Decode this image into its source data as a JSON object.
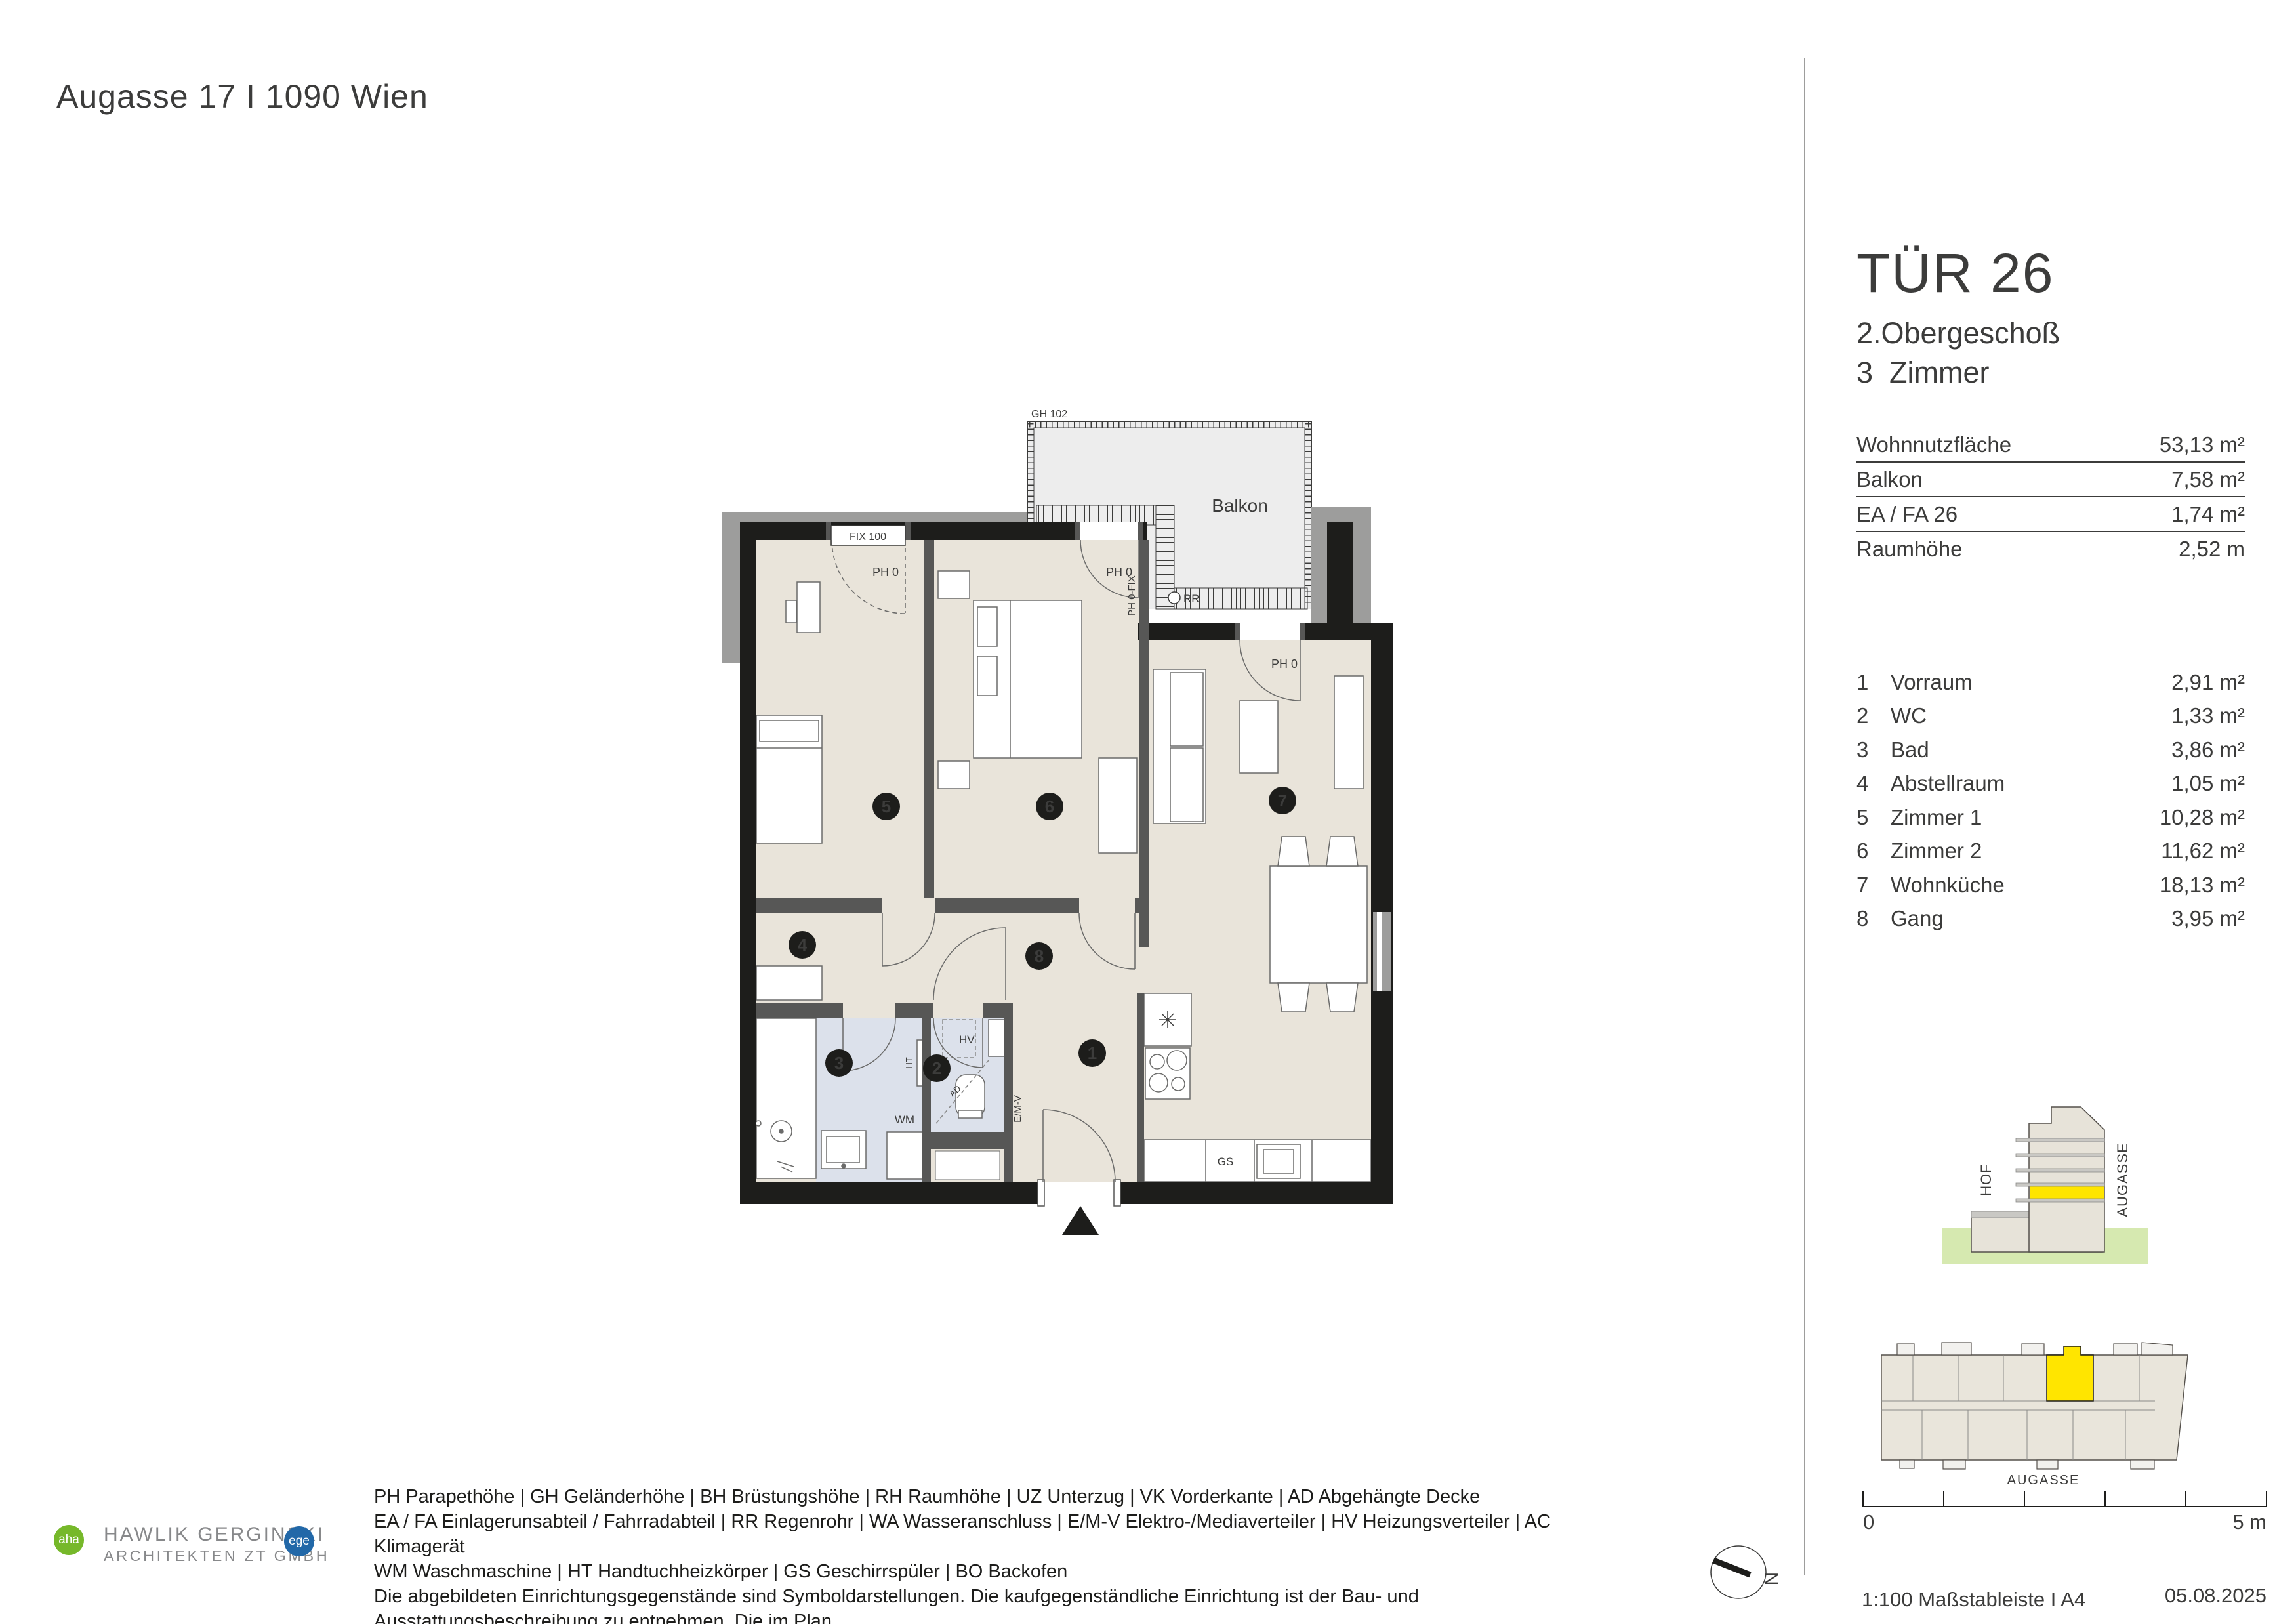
{
  "header": {
    "title": "Augasse 17 I 1090 Wien"
  },
  "unit_panel": {
    "title": "TÜR 26",
    "floor": "2.Obergeschoß",
    "rooms_count": "3  Zimmer",
    "summary": [
      {
        "label": "Wohnnutzfläche",
        "value": "53,13 m²"
      },
      {
        "label": "Balkon",
        "value": "7,58 m²"
      },
      {
        "label": "EA / FA 26",
        "value": "1,74 m²"
      },
      {
        "label": "Raumhöhe",
        "value": "2,52 m"
      }
    ],
    "room_list": [
      {
        "nr": "1",
        "name": "Vorraum",
        "area": "2,91 m²"
      },
      {
        "nr": "2",
        "name": "WC",
        "area": "1,33 m²"
      },
      {
        "nr": "3",
        "name": "Bad",
        "area": "3,86 m²"
      },
      {
        "nr": "4",
        "name": "Abstellraum",
        "area": "1,05 m²"
      },
      {
        "nr": "5",
        "name": "Zimmer 1",
        "area": "10,28 m²"
      },
      {
        "nr": "6",
        "name": "Zimmer 2",
        "area": "11,62 m²"
      },
      {
        "nr": "7",
        "name": "Wohnküche",
        "area": "18,13 m²"
      },
      {
        "nr": "8",
        "name": "Gang",
        "area": "3,95 m²"
      }
    ]
  },
  "plan": {
    "balcony": "Balkon",
    "gh": "GH 102",
    "fix": "FIX 100",
    "ph0": "PH 0",
    "ph0fix": "PH 0-FIX",
    "rr": "RR",
    "hv": "HV",
    "ad": "AD",
    "ht": "HT",
    "wm": "WM",
    "gs": "GS",
    "emv": "E/M-V",
    "badges": [
      "1",
      "2",
      "3",
      "4",
      "5",
      "6",
      "7",
      "8"
    ]
  },
  "elevation": {
    "hof": "HOF",
    "street": "AUGASSE"
  },
  "site_plan": {
    "street": "AUGASSE"
  },
  "scale_bar": {
    "zero": "0",
    "five": "5 m",
    "caption": "1:100 Maßstableiste I A4",
    "date": "05.08.2025",
    "north": "N"
  },
  "legend": {
    "lines": [
      "PH Parapethöhe | GH Geländerhöhe | BH Brüstungshöhe  |  RH Raumhöhe | UZ Unterzug | VK Vorderkante | AD Abgehängte Decke",
      "EA / FA Einlagerunsabteil / Fahrradabteil | RR Regenrohr | WA Wasseranschluss | E/M-V Elektro-/Mediaverteiler | HV Heizungsverteiler | AC Klimagerät",
      "WM Waschmaschine | HT Handtuchheizkörper | GS Geschirrspüler | BO Backofen",
      "Die abgebildeten Einrichtungsgegenstände sind Symboldarstellungen. Die kaufgegenständliche Einrichtung ist der Bau- und Ausstattungsbeschreibung zu entnehmen. Die im Plan",
      "dargestellten Abmessungen und Raumhöhen können im Zuge der Bauführung Änderungen unterliegen. Für die Bestellung von Einbaumöbeln sind Naturmaße heranzuziehen."
    ]
  },
  "logos": {
    "aha": "aha",
    "company_line1": "HAWLIK GERGINSKI",
    "company_line2": "ARCHITEKTEN ZT GMBH",
    "ege": "ege"
  },
  "colors": {
    "highlight_yellow": "#ffe500",
    "logo_green": "#76b82a",
    "logo_blue": "#2268a8",
    "ground_green": "#d6e9b0",
    "room_beige": "#e9e4da",
    "bath_blue": "#dce1eb",
    "balcony_gray": "#ededed",
    "wall_black": "#1d1d1b",
    "wall_gray": "#575756"
  }
}
